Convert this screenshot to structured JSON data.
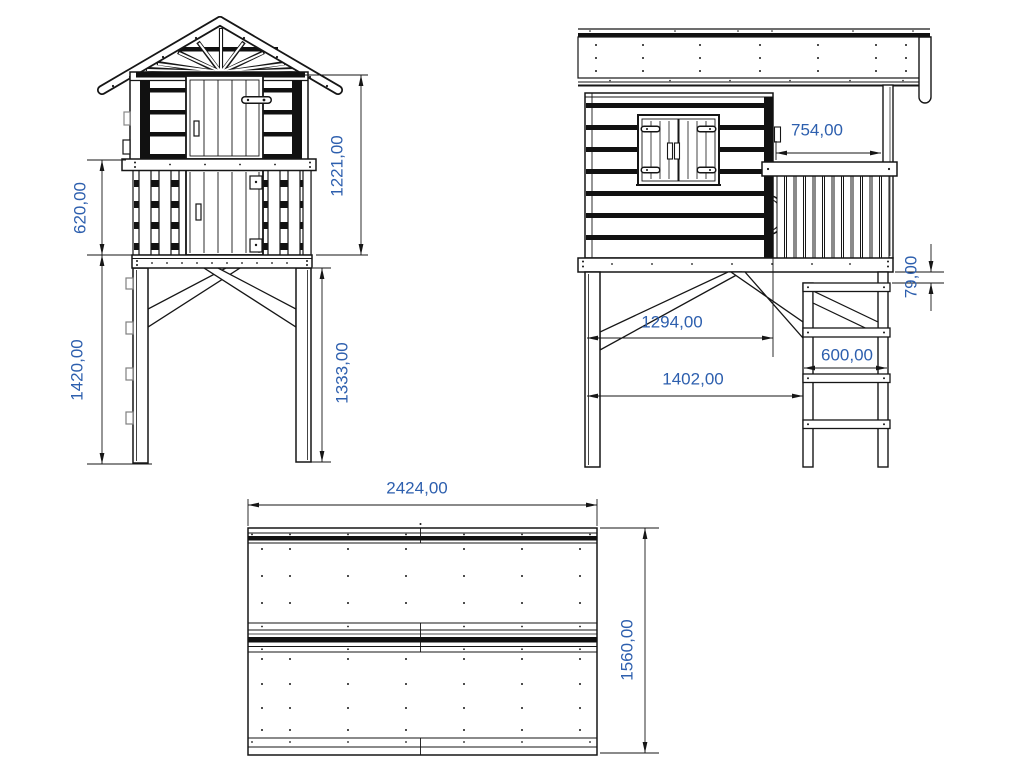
{
  "dims": {
    "d620": "620,00",
    "d1420": "1420,00",
    "d1221": "1221,00",
    "d1333": "1333,00",
    "d754": "754,00",
    "d79": "79,00",
    "d1294": "1294,00",
    "d1402": "1402,00",
    "d600": "600,00",
    "d2424": "2424,00",
    "d1560": "1560,00"
  },
  "colors": {
    "line": "#161616",
    "dark_fill": "#111111",
    "dimension_text": "#2d5fae",
    "background": "#ffffff"
  }
}
